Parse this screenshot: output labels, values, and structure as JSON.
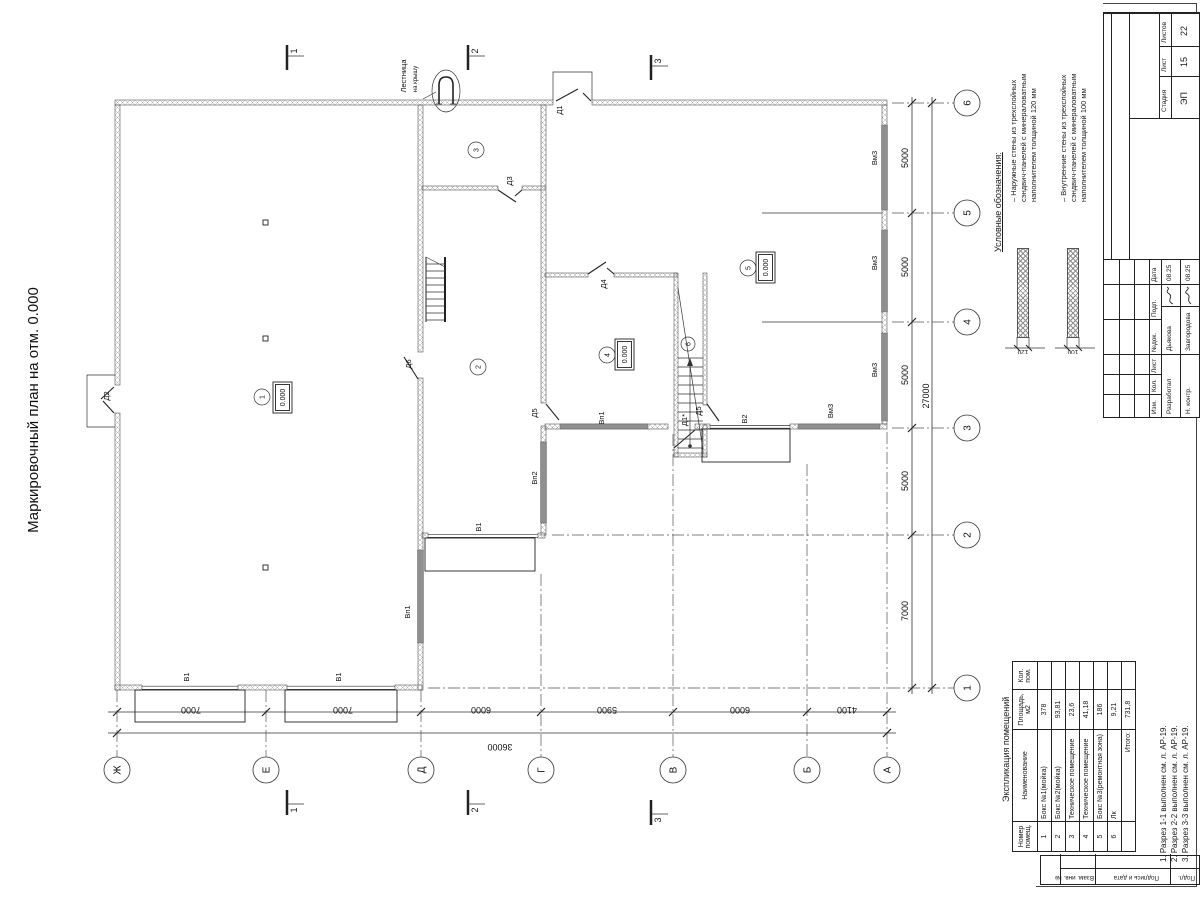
{
  "title": "Маркировочный план на отм. 0.000",
  "plan": {
    "ladder_label1": "Лестница",
    "ladder_label2": "на крышу",
    "elevation": "0.000",
    "rooms": [
      "1",
      "2",
      "3",
      "4",
      "5",
      "6"
    ],
    "doors": {
      "d1": "Д1",
      "d1a": "Д1*",
      "d2": "Д2",
      "d3": "Д3",
      "d4": "Д4",
      "d5": "Д5",
      "d6": "Д6"
    },
    "gates": {
      "v1": "В1",
      "v2": "В2",
      "vp1": "Вп1",
      "vp2": "Вп2",
      "vm3": "Вм3"
    }
  },
  "axes": {
    "letters": [
      "Ж",
      "Е",
      "Д",
      "Г",
      "В",
      "Б",
      "А"
    ],
    "numbers": [
      "6",
      "5",
      "4",
      "3",
      "2",
      "1"
    ],
    "bottom_dims": [
      "7000",
      "7000",
      "6000",
      "5900",
      "6000",
      "4100"
    ],
    "bottom_total": "36000",
    "right_dims": [
      "5000",
      "5000",
      "5000",
      "5000",
      "7000"
    ],
    "right_total": "27000"
  },
  "sections": {
    "s1": "1",
    "s2": "2",
    "s3": "3"
  },
  "legend": {
    "heading": "Условные обозначения:",
    "items": [
      {
        "text": "– Наружные стены из трехслойных\nсэндвич-панелей с минераловатным\nнаполнителем толщиной 120 мм",
        "dim": "120"
      },
      {
        "text": "– Внутренние стены из трехслойных\nсэндвич-панелей с минераловатным\nнаполнителем толщиной 100 мм",
        "dim": "100"
      }
    ]
  },
  "stamp": {
    "change_headers": [
      "Изм.",
      "Кол.",
      "Лист",
      "№док.",
      "Подп.",
      "Дата"
    ],
    "rows": [
      {
        "role": "Разработал",
        "name": "Дьякова",
        "date": "08.25"
      },
      {
        "role": "Н. контр.",
        "name": "Завгородова",
        "date": "08.25"
      }
    ],
    "stage_label": "Стадия",
    "sheet_label": "Лист",
    "sheets_label": "Листов",
    "stage": "ЭП",
    "sheet": "15",
    "sheets": "22"
  },
  "side_strip": {
    "c1": "Подл.",
    "c2": "Подпись и дата",
    "c3": "Взам. инв. №"
  },
  "explication": {
    "title": "Экспликация помещений",
    "headers": [
      "Номер помещ.",
      "Наименование",
      "Площадь, м2",
      "Кол. пом."
    ],
    "rows": [
      [
        "1",
        "Бокс №1(мойка)",
        "378",
        ""
      ],
      [
        "2",
        "Бокс №2(мойка)",
        "93,81",
        ""
      ],
      [
        "3",
        "Техническое помещение",
        "23,6",
        ""
      ],
      [
        "4",
        "Техническое помещение",
        "41,18",
        ""
      ],
      [
        "5",
        "Бокс №3(ремонтная зона)",
        "186",
        ""
      ],
      [
        "6",
        "Лк",
        "9,21",
        ""
      ]
    ],
    "total_label": "Итого:",
    "total": "731,8"
  },
  "notes": [
    "1. Разрез 1-1 выполнен см. л. АР-19.",
    "2. Разрез 2-2 выполнен см. л. АР-19.",
    "3. Разрез 3-3 выполнен см. л. АР-19."
  ]
}
